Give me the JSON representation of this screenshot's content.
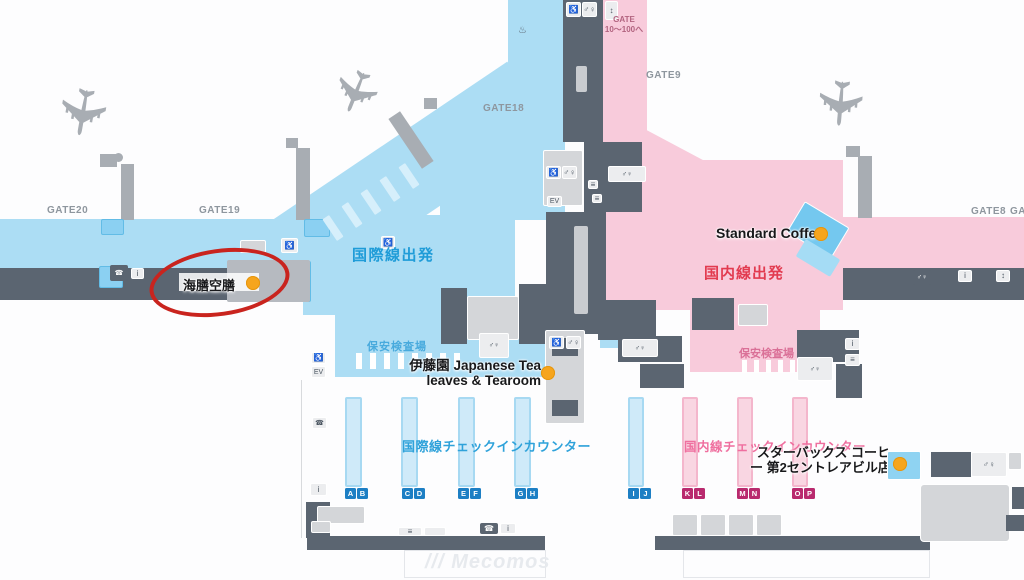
{
  "gates": {
    "gate20": "GATE20",
    "gate19": "GATE19",
    "gate18": "GATE18",
    "gate9": "GATE9",
    "gate8": "GATE8",
    "gate7": "GATE7"
  },
  "gate_note": {
    "line1": "GATE",
    "line2": "10～100へ"
  },
  "areas": {
    "intl_departures": "国際線出発",
    "dom_departures": "国内線出発",
    "security_intl": "保安検査場",
    "security_dom": "保安検査場"
  },
  "checkin": {
    "intl": {
      "label": "国際線チェックインカウンター",
      "counters": [
        [
          "A",
          "B"
        ],
        [
          "C",
          "D"
        ],
        [
          "E",
          "F"
        ],
        [
          "G",
          "H"
        ]
      ]
    },
    "dom": {
      "label": "国内線チェックインカウンター",
      "counters": [
        [
          "I",
          "J"
        ],
        [
          "K",
          "L"
        ],
        [
          "M",
          "N"
        ],
        [
          "O",
          "P"
        ]
      ]
    }
  },
  "shops": {
    "kaizen_kuzen": {
      "name": "海膳空膳"
    },
    "standard_coffee": {
      "name": "Standard Coffee"
    },
    "itoen": {
      "line1": "伊藤園 Japanese Tea",
      "line2": "leaves & Tearoom"
    },
    "starbucks": {
      "line1": "スターバックス コーヒ",
      "line2": "ー 第2セントレアビル店"
    }
  },
  "watermark_mark": "///",
  "watermark": "Mecomos",
  "icons": {
    "wheelchair": "♿",
    "restroom": "♂♀",
    "elevator": "EV",
    "stairs": "≡",
    "phone": "☎",
    "info": "i",
    "updown": "↕",
    "plane": "✈",
    "spring": "♨"
  },
  "colors": {
    "intl_blue": "#acddf4",
    "dom_pink": "#f8cbdb",
    "intl_text": "#1f9cd8",
    "dom_text": "#e23b50",
    "corridor_slate": "#5b6571",
    "marker_orange": "#f6a51d",
    "annotation_red": "#c9241e",
    "badge_blue": "#1d7fc4",
    "badge_magenta": "#b92a6e"
  }
}
